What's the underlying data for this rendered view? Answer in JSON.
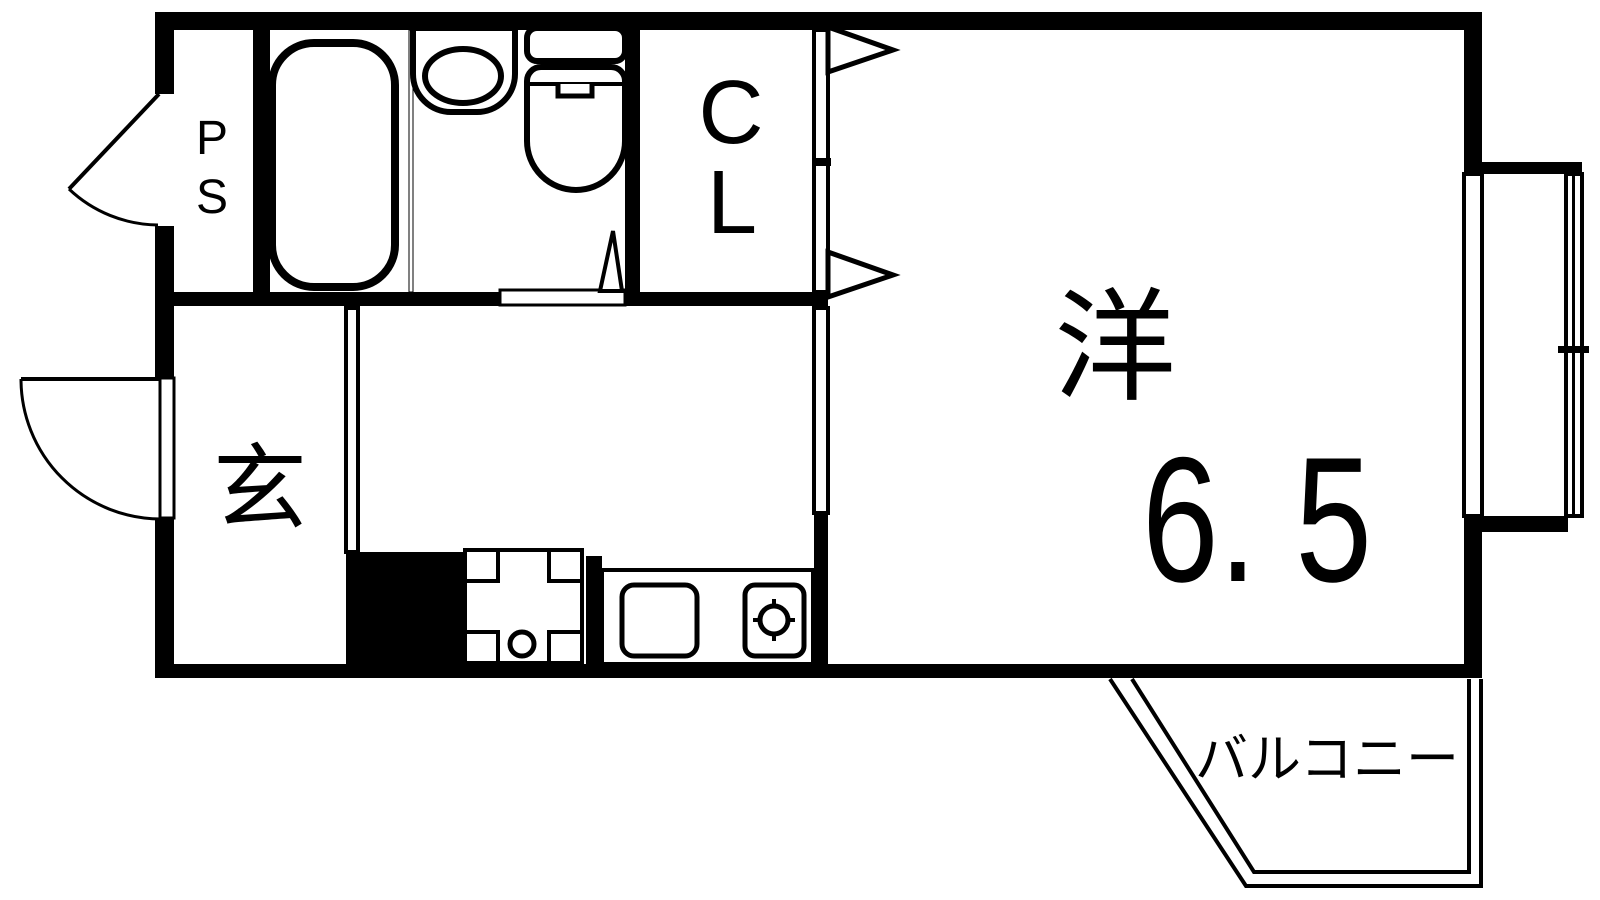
{
  "plan": {
    "colors": {
      "line": "#000000",
      "background": "#ffffff"
    },
    "labels": {
      "pipe_space_line1": "P",
      "pipe_space_line2": "S",
      "closet_line1": "C",
      "closet_line2": "L",
      "entrance": "玄",
      "western_room": "洋",
      "western_room_size": "6. 5",
      "balcony": "バルコニー"
    }
  }
}
